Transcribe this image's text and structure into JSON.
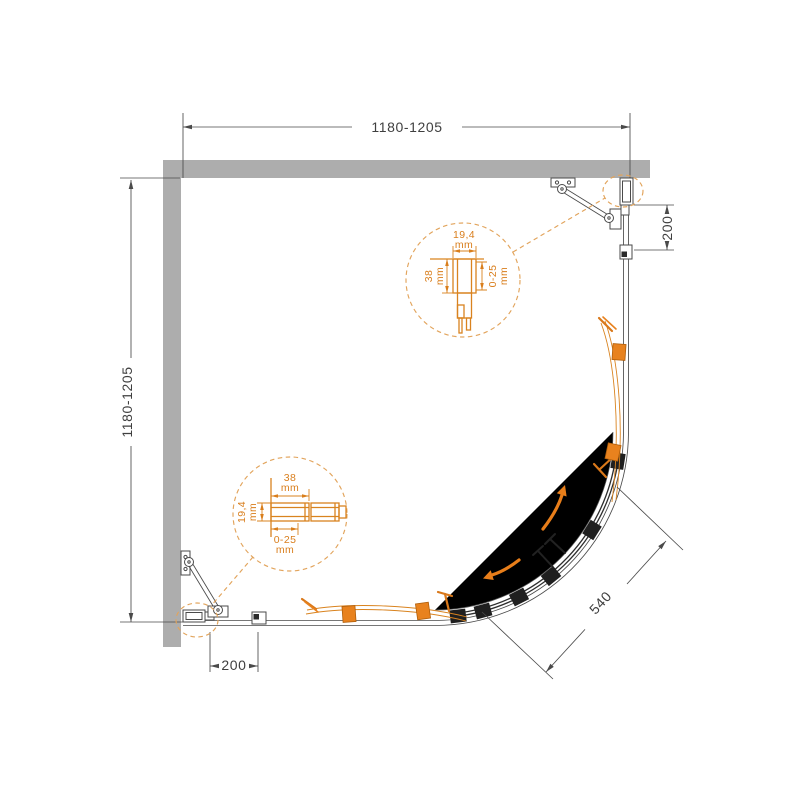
{
  "page": {
    "background": "#FFFFFF"
  },
  "colors": {
    "wall_gray": "#ADADAD",
    "line_dark": "#4A4A4A",
    "accent_orange": "#E8821E",
    "roller_dark": "#1F1F1F"
  },
  "dimensions": {
    "top": "1180-1205",
    "left": "1180-1205",
    "right_offset": "200",
    "bottom_offset": "200",
    "diagonal_opening": "540"
  },
  "detail_top": {
    "width": "19,4",
    "width_unit": "mm",
    "depth": "38",
    "depth_unit": "mm",
    "adjustment": "0-25",
    "adjustment_unit": "mm"
  },
  "detail_bottom": {
    "width": "38",
    "width_unit": "mm",
    "depth": "19,4",
    "depth_unit": "mm",
    "adjustment": "0-25",
    "adjustment_unit": "mm"
  }
}
